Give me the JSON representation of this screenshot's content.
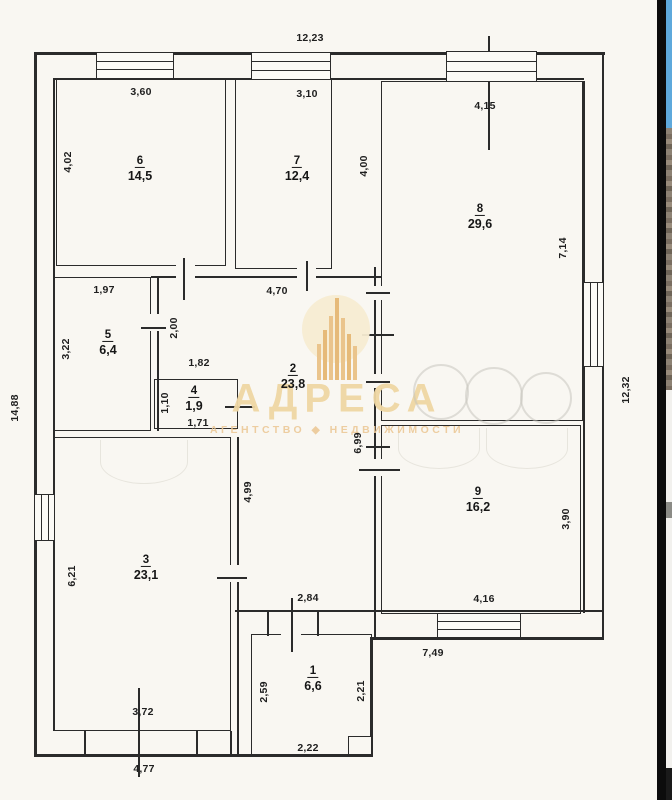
{
  "plan": {
    "rooms": {
      "r1": {
        "number": "1",
        "area": "6,6"
      },
      "r2": {
        "number": "2",
        "area": "23,8"
      },
      "r3": {
        "number": "3",
        "area": "23,1"
      },
      "r4": {
        "number": "4",
        "area": "1,9"
      },
      "r5": {
        "number": "5",
        "area": "6,4"
      },
      "r6": {
        "number": "6",
        "area": "14,5"
      },
      "r7": {
        "number": "7",
        "area": "12,4"
      },
      "r8": {
        "number": "8",
        "area": "29,6"
      },
      "r9": {
        "number": "9",
        "area": "16,2"
      }
    },
    "dims": {
      "overall_top": "12,23",
      "overall_left": "14,88",
      "overall_right": "12,32",
      "overall_bottom": "4,77",
      "room6_width": "3,60",
      "room7_width": "3,10",
      "room8_width": "4,15",
      "room6_height": "4,02",
      "room7_height": "4,00",
      "room8_height": "7,14",
      "room5_width": "1,97",
      "room5_height": "3,22",
      "room5_door": "2,00",
      "hall_top": "4,70",
      "room4_top": "1,82",
      "room4_height": "1,10",
      "room4_bottom": "1,71",
      "hall_mid": "4,99",
      "hall_right": "6,99",
      "hall_bottom": "2,84",
      "room3_height": "6,21",
      "room3_bottom": "3,72",
      "room9_height": "3,90",
      "room9_bottom": "4,16",
      "bottom_right": "7,49",
      "room1_left": "2,59",
      "room1_right": "2,21",
      "room1_bottom": "2,22"
    }
  },
  "watermark": {
    "title": "АДРЕСА",
    "subtitle": "АГЕНТСТВО ◆ НЕДВИЖИМОСТИ"
  },
  "colors": {
    "paper": "#f9f7f2",
    "line": "#2b2b2b",
    "watermark_beige": "#efd7a4",
    "edge_sky": "#5ea9dc"
  }
}
